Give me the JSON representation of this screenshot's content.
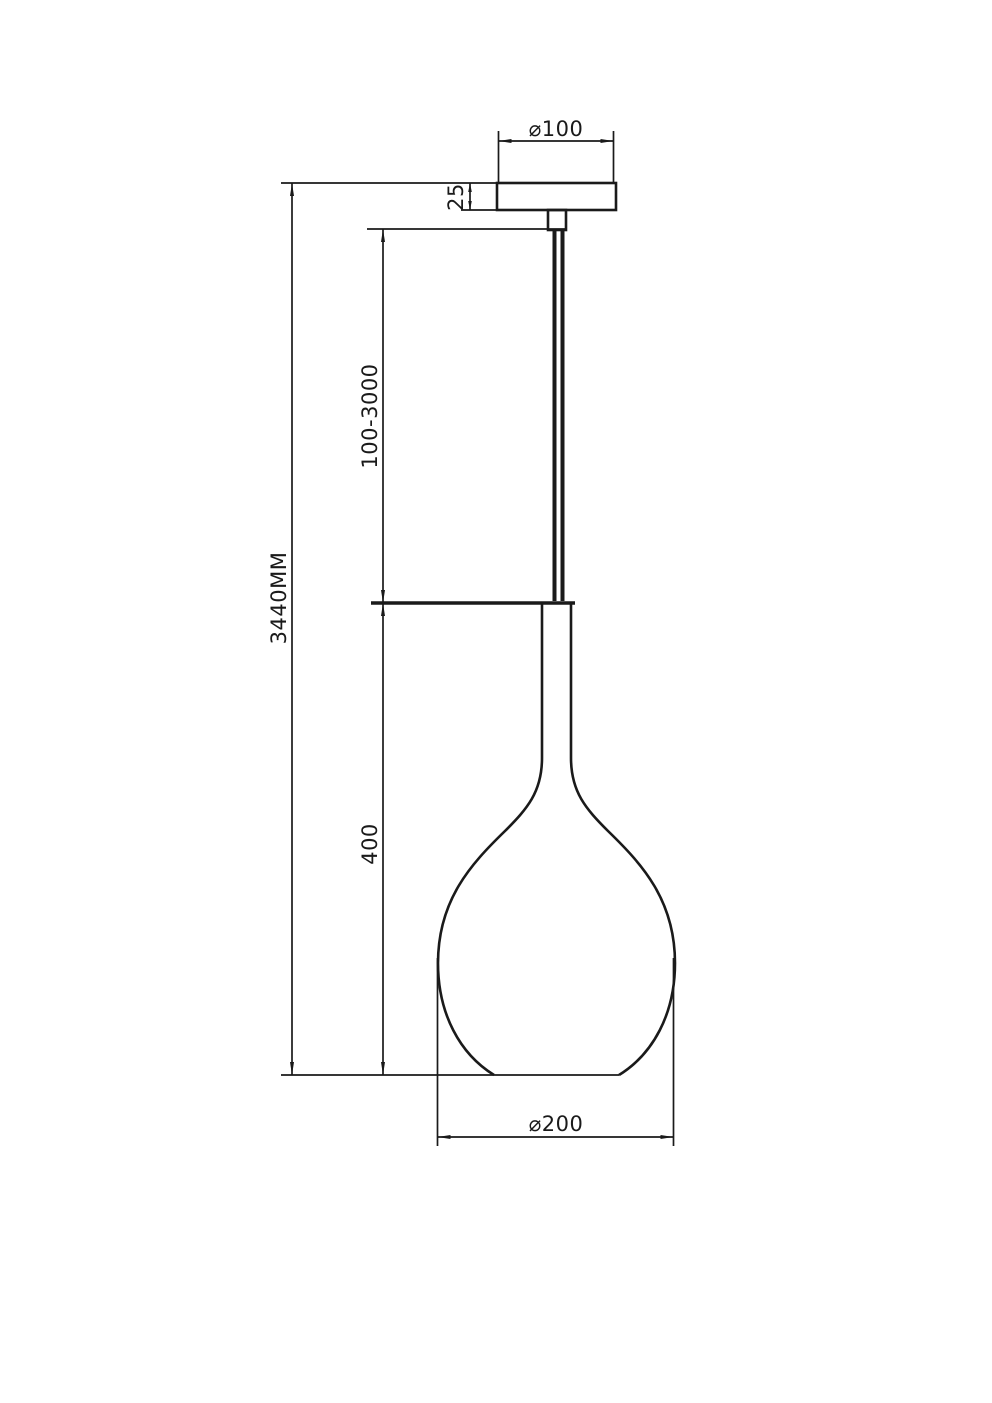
{
  "colors": {
    "background": "#ffffff",
    "line": "#1a1a1a"
  },
  "dimensions": {
    "canopy_diameter": "⌀100",
    "canopy_height": "25",
    "suspension_range": "100-3000",
    "overall_height": "3440MM",
    "shade_height": "400",
    "shade_diameter": "⌀200"
  }
}
